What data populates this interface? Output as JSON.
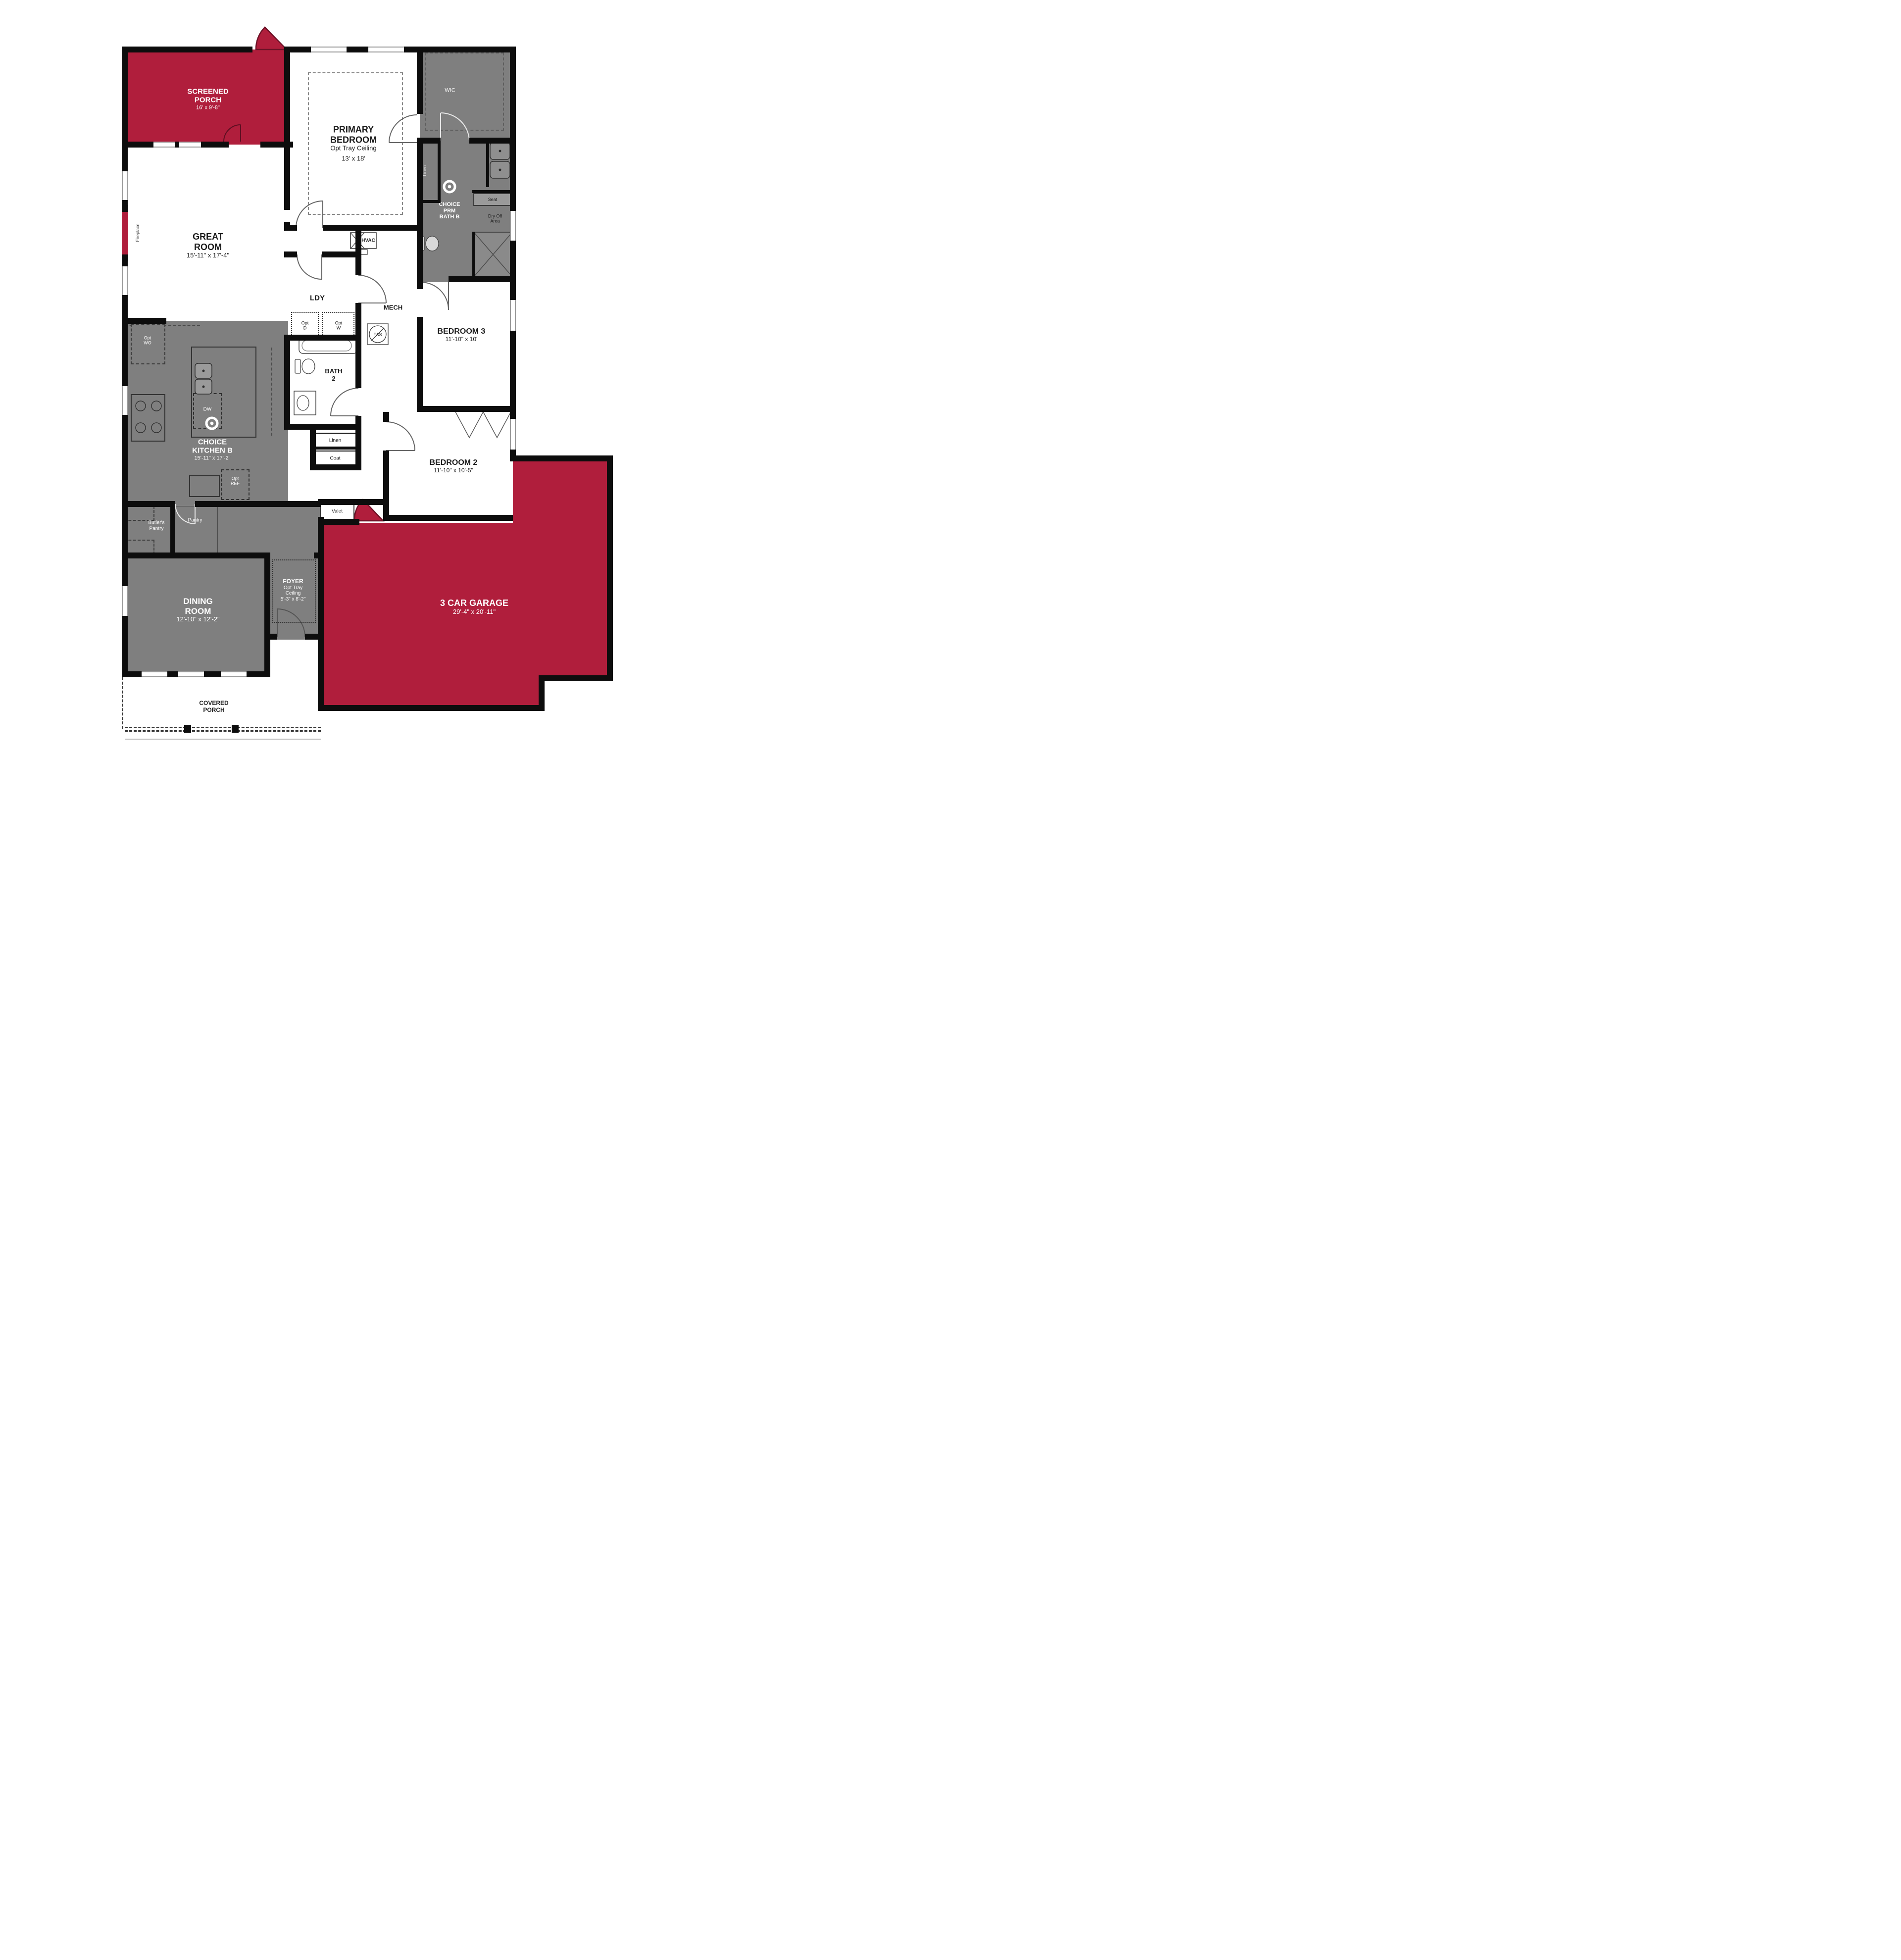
{
  "plan_title": "Single-story floor plan",
  "colors": {
    "accent_red": "#B01E3C",
    "room_gray": "#7F7F7F",
    "wall_black": "#0D0D0D",
    "floor_white": "#FFFFFF"
  },
  "rooms": {
    "screened_porch": {
      "lines": [
        "SCREENED",
        "PORCH"
      ],
      "dims": "16' x 9'-8\""
    },
    "primary_bedroom": {
      "lines": [
        "PRIMARY",
        "BEDROOM"
      ],
      "sub": "Opt Tray Ceiling",
      "dims": "13' x 18'"
    },
    "wic": {
      "label": "WIC"
    },
    "linen_primary": {
      "label": "Linen"
    },
    "prm_bath": {
      "lines": [
        "CHOICE",
        "PRM",
        "BATH B"
      ]
    },
    "seat": {
      "label": "Seat"
    },
    "dry_off": {
      "lines": [
        "Dry Off",
        "Area"
      ]
    },
    "great_room": {
      "lines": [
        "GREAT",
        "ROOM"
      ],
      "dims": "15'-11\" x 17'-4\""
    },
    "fireplace": {
      "label": "Fireplace"
    },
    "hvac": {
      "label": "HVAC"
    },
    "mech": {
      "label": "MECH"
    },
    "fas": {
      "label": "FAS"
    },
    "ldy": {
      "label": "LDY"
    },
    "opt_d": {
      "lines": [
        "Opt",
        "D"
      ]
    },
    "opt_w": {
      "lines": [
        "Opt",
        "W"
      ]
    },
    "bedroom3": {
      "label": "BEDROOM 3",
      "dims": "11'-10\" x 10'"
    },
    "bath2": {
      "lines": [
        "BATH",
        "2"
      ]
    },
    "linen_hall": {
      "label": "Linen"
    },
    "coat": {
      "label": "Coat"
    },
    "kitchen": {
      "lines": [
        "CHOICE",
        "KITCHEN B"
      ],
      "dims": "15'-11\" x 17'-2\""
    },
    "opt_wo": {
      "lines": [
        "Opt",
        "WO"
      ]
    },
    "dw": {
      "label": "DW"
    },
    "opt_ref": {
      "lines": [
        "Opt",
        "REF"
      ]
    },
    "bedroom2": {
      "label": "BEDROOM 2",
      "dims": "11'-10\" x 10'-5\""
    },
    "butlers_pantry": {
      "lines": [
        "Butler's",
        "Pantry"
      ]
    },
    "pantry": {
      "label": "Pantry"
    },
    "valet": {
      "label": "Valet"
    },
    "foyer": {
      "label": "FOYER",
      "sub_lines": [
        "Opt Tray",
        "Ceiling"
      ],
      "dims": "5'-3\" x 8'-2\""
    },
    "dining_room": {
      "lines": [
        "DINING",
        "ROOM"
      ],
      "dims": "12'-10\" x 12'-2\""
    },
    "garage": {
      "label": "3 CAR GARAGE",
      "dims": "29'-4\" x 20'-11\""
    },
    "covered_porch": {
      "lines": [
        "COVERED",
        "PORCH"
      ]
    }
  }
}
